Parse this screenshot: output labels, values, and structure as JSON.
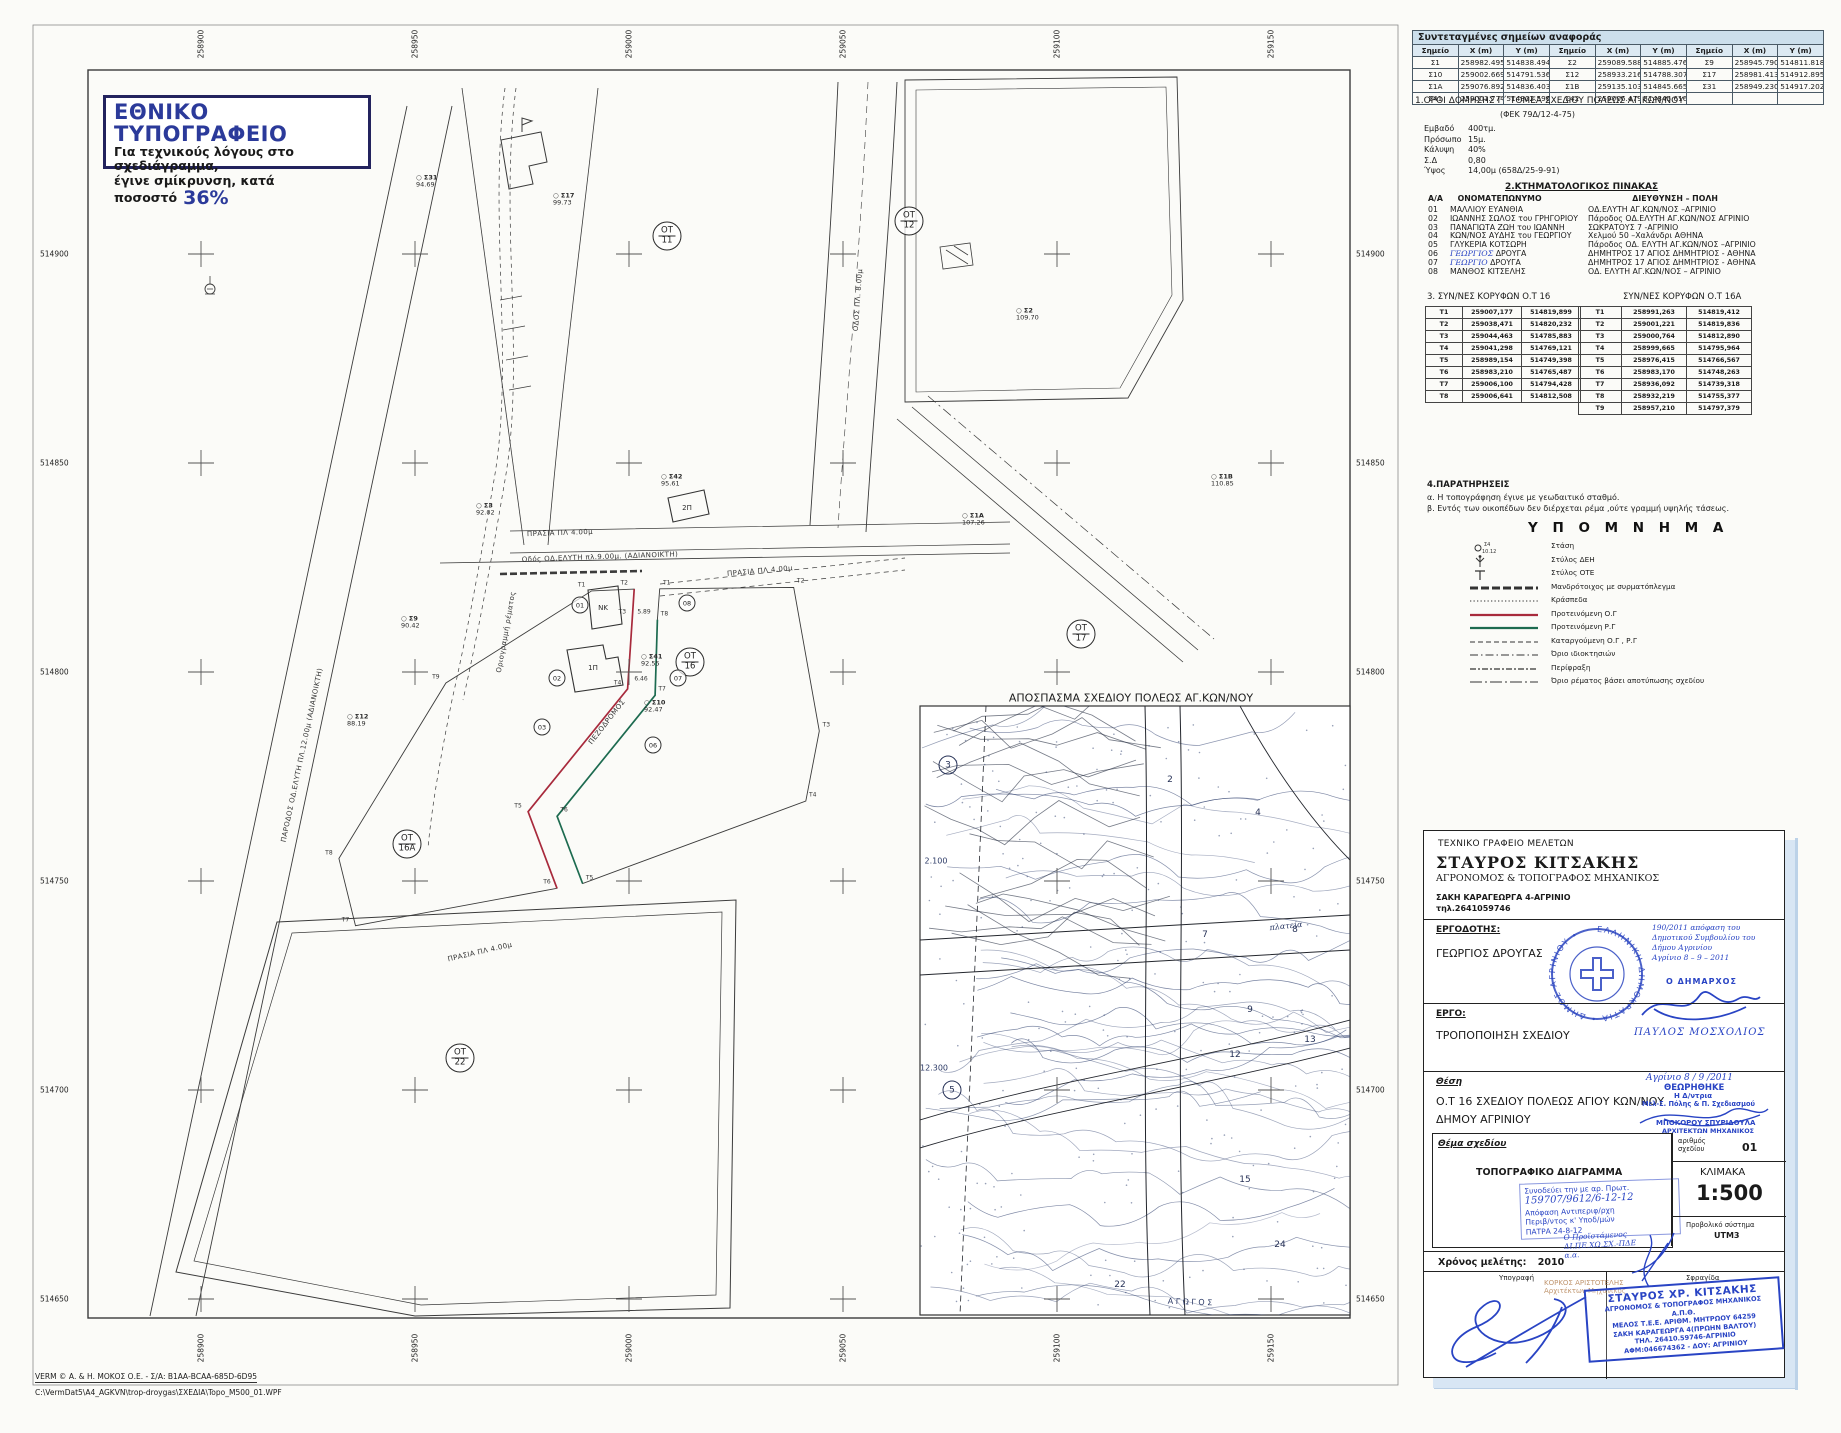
{
  "printer_note": {
    "title": "ΕΘΝΙΚΟ ΤΥΠΟΓΡΑΦΕΙΟ",
    "line1": "Για τεχνικούς λόγους στο σχεδιάγραμμα,",
    "line2": "έγινε σμίκρυνση, κατά ποσοστό",
    "percent": "36%"
  },
  "ref_table": {
    "title": "Συντεταγμένες σημείων αναφοράς",
    "headers": [
      "Σημείο",
      "X (m)",
      "Y (m)",
      "Σημείο",
      "X (m)",
      "Y (m)",
      "Σημείο",
      "X (m)",
      "Y (m)"
    ],
    "rows": [
      [
        "Σ1",
        "258982.495",
        "514838.494",
        "Σ2",
        "259089.588",
        "514885.476",
        "Σ9",
        "258945.790",
        "514811.818"
      ],
      [
        "Σ10",
        "259002.669",
        "514791.536",
        "Σ12",
        "258933.216",
        "514788.307",
        "Σ17",
        "258981.413",
        "514912.895"
      ],
      [
        "Σ1Α",
        "259076.892",
        "514836.403",
        "Σ1Β",
        "259135.103",
        "514845.665",
        "Σ31",
        "258949.230",
        "514917.202"
      ],
      [
        "Σ41",
        "259001.774",
        "514802.596",
        "Σ42",
        "259006.479",
        "514845.616",
        "",
        "",
        ""
      ]
    ]
  },
  "section1": {
    "heading": "1.ΟΡΟΙ ΔΟΜΗΣΗΣ  Γ΄ ΤΟΜΕΑ  ΣΧΕΔΙΟΥ ΠΟΛΕΩΣ ΑΓ.ΚΩΝ/ΝΟΥ",
    "fek": "(ΦΕΚ 79Δ/12-4-75)",
    "items": [
      [
        "Εμβαδό",
        "400τμ."
      ],
      [
        "Πρόσωπο",
        "15μ."
      ],
      [
        "Κάλυψη",
        "40%"
      ],
      [
        "Σ.Δ",
        "0,80"
      ],
      [
        "Ύψος",
        "14,00μ (658Δ/25-9-91)"
      ]
    ]
  },
  "section2": {
    "heading": "2.ΚΤΗΜΑΤΟΛΟΓΙΚΟΣ ΠΙΝΑΚΑΣ",
    "col_no": "Α/Α",
    "col_name": "ΟΝΟΜΑΤΕΠΩΝΥΜΟ",
    "col_addr": "ΔΙΕΥΘΥΝΣΗ – ΠΟΛΗ",
    "rows": [
      {
        "no": "01",
        "name": "ΜΑΛΛΙΟΥ ΕΥΑΝΘΙΑ",
        "addr": "ΟΔ.ΕΛΥΤΗ ΑΓ.ΚΩΝ/ΝΟΣ –ΑΓΡΙΝΙΟ",
        "hw": false
      },
      {
        "no": "02",
        "name": "ΙΩΑΝΝΗΣ ΣΩΛΟΣ του ΓΡΗΓΟΡΙΟΥ",
        "addr": "Πάροδος ΟΔ.ΕΛΥΤΗ ΑΓ.ΚΩΝ/ΝΟΣ ΑΓΡΙΝΙΟ",
        "hw": false
      },
      {
        "no": "03",
        "name": "ΠΑΝΑΓΙΩΤΑ ΖΩΗ του ΙΩΑΝΝΗ",
        "addr": "ΣΩΚΡΑΤΟΥΣ 7 -ΑΓΡΙΝΙΟ",
        "hw": false
      },
      {
        "no": "04",
        "name": "ΚΩΝ/ΝΟΣ ΑΥΔΗΣ του ΓΕΩΡΓΙΟΥ",
        "addr": "Χελμού 50 –Χαλάνδρι ΑΘΗΝΑ",
        "hw": false
      },
      {
        "no": "05",
        "name": "ΓΛΥΚΕΡΙΑ ΚΟΤΣΩΡΗ",
        "addr": "Πάροδος ΟΔ. ΕΛΥΤΗ ΑΓ.ΚΩΝ/ΝΟΣ –ΑΓΡΙΝΙΟ",
        "hw": false
      },
      {
        "no": "06",
        "name": "ΓΕΩΡΓΙΟΣ ΔΡΟΥΓΑ",
        "addr": "ΔΗΜΗΤΡΟΣ 17 ΑΓΙΟΣ ΔΗΜΗΤΡΙΟΣ - ΑΘΗΝΑ",
        "hw": true
      },
      {
        "no": "07",
        "name": "ΓΕΩΡΓΙΟ ΔΡΟΥΓΑ",
        "addr": "ΔΗΜΗΤΡΟΣ 17 ΑΓΙΟΣ ΔΗΜΗΤΡΙΟΣ - ΑΘΗΝΑ",
        "hw": true
      },
      {
        "no": "08",
        "name": "ΜΑΝΘΟΣ ΚΙΤΣΕΛΗΣ",
        "addr": "ΟΔ. ΕΛΥΤΗ ΑΓ.ΚΩΝ/ΝΟΣ – ΑΓΡΙΝΙΟ",
        "hw": false
      }
    ]
  },
  "section3": {
    "heading_left": "3.      ΣΥΝ/ΝΕΣ ΚΟΡΥΦΩΝ Ο.Τ 16",
    "heading_right": "ΣΥΝ/ΝΕΣ ΚΟΡΥΦΩΝ Ο.Τ 16Α",
    "t16": [
      [
        "Τ1",
        "259007,177",
        "514819,899"
      ],
      [
        "Τ2",
        "259038,471",
        "514820,232"
      ],
      [
        "Τ3",
        "259044,463",
        "514785,883"
      ],
      [
        "Τ4",
        "259041,298",
        "514769,121"
      ],
      [
        "Τ5",
        "258989,154",
        "514749,398"
      ],
      [
        "Τ6",
        "258983,210",
        "514765,487"
      ],
      [
        "Τ7",
        "259006,100",
        "514794,428"
      ],
      [
        "Τ8",
        "259006,641",
        "514812,508"
      ]
    ],
    "t16a": [
      [
        "Τ1",
        "258991,263",
        "514819,412"
      ],
      [
        "Τ2",
        "259001,221",
        "514819,836"
      ],
      [
        "Τ3",
        "259000,764",
        "514812,890"
      ],
      [
        "Τ4",
        "258999,665",
        "514795,964"
      ],
      [
        "Τ5",
        "258976,415",
        "514766,567"
      ],
      [
        "Τ6",
        "258983,170",
        "514748,263"
      ],
      [
        "Τ7",
        "258936,092",
        "514739,318"
      ],
      [
        "Τ8",
        "258932,219",
        "514755,377"
      ],
      [
        "Τ9",
        "258957,210",
        "514797,379"
      ]
    ]
  },
  "section4": {
    "heading": "4.ΠΑΡΑΤΗΡΗΣΕΙΣ",
    "note_a": "α. Η τοπογράφηση έγινε με γεωδαιτικό σταθμό.",
    "note_b": "β. Εντός των οικοπέδων δεν διέρχεται ρέμα ,ούτε γραμμή υψηλής τάσεως."
  },
  "legend": {
    "title": "Υ Π Ο Μ Ν Η Μ Α",
    "items": [
      {
        "symbol": "stasi",
        "label": "Στάση"
      },
      {
        "symbol": "deh",
        "label": "Στύλος ΔΕΗ"
      },
      {
        "symbol": "ote",
        "label": "Στύλος ΟΤΕ"
      },
      {
        "symbol": "wall",
        "label": "Μανδρότοιχος με συρματόπλεγμα"
      },
      {
        "symbol": "dots",
        "label": "Κράσπεδα"
      },
      {
        "symbol": "red",
        "label": "Προτεινόμενη Ο.Γ"
      },
      {
        "symbol": "green",
        "label": "Προτεινόμενη Ρ.Γ"
      },
      {
        "symbol": "dashed",
        "label": "Καταργούμενη Ο.Γ , Ρ.Γ"
      },
      {
        "symbol": "dashdot",
        "label": "Όριο ιδιοκτησιών"
      },
      {
        "symbol": "fence",
        "label": "Περίφραξη"
      },
      {
        "symbol": "stream",
        "label": "Όριο ρέματος βάσει αποτύπωσης σχεδίου"
      }
    ],
    "stasi_name": "Σ4",
    "stasi_elev": "10.12"
  },
  "title_block": {
    "office": "ΤΕΧΝΙΚΟ ΓΡΑΦΕΙΟ ΜΕΛΕΤΩΝ",
    "name": "ΣΤΑΥΡΟΣ ΚΙΤΣΑΚΗΣ",
    "profession": "ΑΓΡΟΝΟΜΟΣ & ΤΟΠΟΓΡΑΦΟΣ ΜΗΧΑΝΙΚΟΣ",
    "address": "ΣΑΚΗ ΚΑΡΑΓΕΩΡΓΑ 4-ΑΓΡΙΝΙΟ",
    "phone": "τηλ.2641059746",
    "employer_label": "ΕΡΓΟΔΟΤΗΣ:",
    "employer": "ΓΕΩΡΓΙΟΣ ΔΡΟΥΓΑΣ",
    "project_label": "ΕΡΓΟ:",
    "project": "ΤΡΟΠΟΠΟΙΗΣΗ ΣΧΕΔΙΟΥ",
    "location_label": "Θέση",
    "location_line1": "Ο.Τ 16 ΣΧΕΔΙΟΥ ΠΟΛΕΩΣ ΑΓΙΟΥ ΚΩΝ/ΝΟΥ",
    "location_line2": "ΔΗΜΟΥ ΑΓΡΙΝΙΟΥ",
    "subject_label": "Θέμα σχεδίου",
    "subject": "ΤΟΠΟΓΡΑΦΙΚΟ ΔΙΑΓΡΑΜΜΑ",
    "drawing_no_label1": "αριθμός",
    "drawing_no_label2": "σχεδίου",
    "drawing_no": "01",
    "scale_label": "ΚΛΙΜΑΚΑ",
    "scale": "1:500",
    "projection_label": "Προβολικό σύστημα",
    "projection": "UTM3",
    "study_label": "Χρόνος μελέτης:",
    "study_year": "2010",
    "signature_label": "Υπογραφή",
    "stamp_label": "Σφραγίδα"
  },
  "stamps": {
    "municipal": {
      "ring": "ΕΛΛΗΝΙΚΗ ΔΗΜΟΚΡΑΤΙΑ • ΔΗΜΟΣ ΑΓΡΙΝΙΟΥ •",
      "note_lines": [
        "190/2011 απόφαση του",
        "Δημοτικού Συμβουλίου του",
        "Δήμου Αγρινίου",
        "Αγρίνιο  8 – 9 – 2011"
      ],
      "mayor_label": "Ο  ΔΗΜΑΡΧΟΣ",
      "mayor_name": "ΠΑΥΛΟΣ  ΜΟΣΧΟΛΙΟΣ"
    },
    "approval": {
      "date_line": "Αγρίνιο 8 / 9 /2011",
      "line1": "ΘΕΩΡΗΘΗΚΕ",
      "line2": "Η Δ/ντρια",
      "line3": "Μελ-Σ. Πόλης & Π. Σχεδιασμού",
      "name": "ΜΠΟΚΟΡΟΥ ΣΠΥΡΙΔΟΥΛΑ",
      "title": "ΑΡΧΙΤΕΚΤΩΝ ΜΗΧΑΝΙΚΟΣ"
    },
    "protocol": {
      "lines": [
        "Συνοδεύει την με αρ. Πρωτ.",
        "159707/9612/6-12-12",
        "Απόφαση Αντιπεριφ/ρχη",
        "Περιβ/ντος κ' Υποδ/μών",
        "ΠΑΤΡΑ  24-8-12"
      ]
    },
    "head_official": {
      "lines": [
        "Ο Προϊστάμενος",
        "ΔΙ.ΠΕ.ΧΩ.ΣΧ.-ΠΔΕ",
        "α.α."
      ],
      "name": "ΚΟΡΚΟΣ ΑΡΙΣΤΟΤΕΛΗΣ",
      "title": "Αρχιτέκτων Μηχανικός"
    },
    "engineer": {
      "lines": [
        "ΣΤΑΥΡΟΣ ΧΡ. ΚΙΤΣΑΚΗΣ",
        "ΑΓΡΟΝΟΜΟΣ & ΤΟΠΟΓΡΑΦΟΣ ΜΗΧΑΝΙΚΟΣ Α.Π.Θ.",
        "ΜΕΛΟΣ Τ.Ε.Ε. ΑΡΙΘΜ. ΜΗΤΡΩΟΥ 64259",
        "ΣΑΚΗ ΚΑΡΑΓΕΩΡΓΑ 4(ΠΡΩΗΝ ΒΑΛΤΟΥ)",
        "ΤΗΛ. 26410.59746-ΑΓΡΙΝΙΟ",
        "ΑΦΜ:046674362 - ΔΟΥ: ΑΓΡΙΝΙΟΥ"
      ]
    }
  },
  "map": {
    "inset_title": "ΑΠΟΣΠΑΣΜΑ ΣΧΕΔΙΟΥ ΠΟΛΕΩΣ ΑΓ.ΚΩΝ/ΝΟΥ",
    "grid": {
      "x_positions": [
        201,
        415,
        629,
        843,
        1057,
        1271
      ],
      "y_positions": [
        254,
        463,
        672,
        881,
        1090,
        1299
      ],
      "x_values": [
        "258900",
        "258950",
        "259000",
        "259050",
        "259100",
        "259150"
      ],
      "y_values": [
        "514900",
        "514850",
        "514800",
        "514750",
        "514700",
        "514650"
      ]
    },
    "ot_labels": [
      {
        "block": "ΟΤ",
        "num": "11",
        "x": 667,
        "y": 236
      },
      {
        "block": "ΟΤ",
        "num": "12",
        "x": 909,
        "y": 221
      },
      {
        "block": "ΟΤ",
        "num": "16",
        "x": 690,
        "y": 662
      },
      {
        "block": "ΟΤ",
        "num": "16Α",
        "x": 407,
        "y": 844
      },
      {
        "block": "ΟΤ",
        "num": "17",
        "x": 1081,
        "y": 634
      },
      {
        "block": "ΟΤ",
        "num": "22",
        "x": 460,
        "y": 1058
      }
    ],
    "survey_points": [
      {
        "name": "Σ31",
        "elev": "94.69",
        "x": 412,
        "y": 182
      },
      {
        "name": "Σ17",
        "elev": "99.73",
        "x": 549,
        "y": 200
      },
      {
        "name": "Σ42",
        "elev": "95.61",
        "x": 657,
        "y": 481
      },
      {
        "name": "Σ3",
        "elev": "92.02",
        "x": 472,
        "y": 510
      },
      {
        "name": "Σ1Α",
        "elev": "107.26",
        "x": 958,
        "y": 520
      },
      {
        "name": "Σ1Β",
        "elev": "110.85",
        "x": 1207,
        "y": 481
      },
      {
        "name": "Σ2",
        "elev": "109.70",
        "x": 1012,
        "y": 315
      },
      {
        "name": "Σ9",
        "elev": "90.42",
        "x": 397,
        "y": 623
      },
      {
        "name": "Σ41",
        "elev": "92.55",
        "x": 637,
        "y": 661
      },
      {
        "name": "Σ10",
        "elev": "92.47",
        "x": 640,
        "y": 707
      },
      {
        "name": "Σ12",
        "elev": "88.19",
        "x": 343,
        "y": 721
      }
    ],
    "parcel_numbers": [
      {
        "n": "01",
        "x": 580,
        "y": 605
      },
      {
        "n": "02",
        "x": 557,
        "y": 678
      },
      {
        "n": "03",
        "x": 542,
        "y": 727
      },
      {
        "n": "06",
        "x": 653,
        "y": 745
      },
      {
        "n": "07",
        "x": 678,
        "y": 678
      },
      {
        "n": "08",
        "x": 687,
        "y": 603
      }
    ],
    "building_labels": [
      {
        "t": "ΝΚ",
        "x": 603,
        "y": 608
      },
      {
        "t": "1Π",
        "x": 593,
        "y": 668
      },
      {
        "t": "2Π",
        "x": 687,
        "y": 508
      }
    ],
    "dims": [
      {
        "t": "5.89",
        "x": 644,
        "y": 612
      },
      {
        "t": "6.46",
        "x": 641,
        "y": 679
      }
    ],
    "road_labels": [
      {
        "t": "ΠΡΑΣΙΑ ΠΛ 4.00μ",
        "x": 560,
        "y": 533,
        "r": -2
      },
      {
        "t": "Οδός ΟΔ.ΕΛΥΤΗ πλ.9.00μ. (ΑΔΙΑΝΟΙΚΤΗ)",
        "x": 600,
        "y": 557,
        "r": -2
      },
      {
        "t": "ΠΡΑΣΙΑ ΠΛ 4.00μ",
        "x": 760,
        "y": 571,
        "r": -5
      },
      {
        "t": "ΠΕΖΟΔΡΟΜΟΣ",
        "x": 607,
        "y": 722,
        "r": -52
      },
      {
        "t": "ΠΡΑΣΙΑ ΠΛ 4.00μ",
        "x": 480,
        "y": 952,
        "r": -13
      },
      {
        "t": "ΠΑΡΟΔΟΣ ΟΔ.ΕΛΥΤΗ ΠΛ.12.00μ (ΑΔΙΑΝΟΙΚΤΗ)",
        "x": 302,
        "y": 755,
        "r": -78
      },
      {
        "t": "ΟΔΟΣ ΠΛ. 8.00μ",
        "x": 858,
        "y": 300,
        "r": -86
      },
      {
        "t": "Οριογραμμή ρέματος",
        "x": 506,
        "y": 632,
        "r": -80
      }
    ],
    "inset_numbers_circled": [
      {
        "n": "3",
        "x": 948,
        "y": 765
      },
      {
        "n": "5",
        "x": 952,
        "y": 1090
      }
    ],
    "inset_numbers": [
      {
        "n": "2",
        "x": 1170,
        "y": 780
      },
      {
        "n": "4",
        "x": 1258,
        "y": 813
      },
      {
        "n": "7",
        "x": 1205,
        "y": 935
      },
      {
        "n": "8",
        "x": 1295,
        "y": 930
      },
      {
        "n": "9",
        "x": 1250,
        "y": 1010
      },
      {
        "n": "12",
        "x": 1235,
        "y": 1055
      },
      {
        "n": "13",
        "x": 1310,
        "y": 1040
      },
      {
        "n": "15",
        "x": 1245,
        "y": 1180
      },
      {
        "n": "24",
        "x": 1280,
        "y": 1245
      },
      {
        "n": "22",
        "x": 1120,
        "y": 1285
      }
    ],
    "inset_texts": [
      {
        "t": "πλατεία",
        "x": 1286,
        "y": 926,
        "r": -6,
        "hw": true
      },
      {
        "t": "Α Γ Ω Γ Ο Σ",
        "x": 1190,
        "y": 1302,
        "r": 2,
        "hw": false
      },
      {
        "t": "12.300",
        "x": 934,
        "y": 1068,
        "r": 0,
        "hw": false
      },
      {
        "t": "2.100",
        "x": 936,
        "y": 861,
        "r": 0,
        "hw": false
      }
    ]
  },
  "footer": {
    "verm_line": "VERM © Α. & Η. ΜΟΚΟΣ Ο.Ε. - Σ/Α: Β1ΑΑ-ΒCΑΑ-685D-6D95",
    "path_line": "C:\\VermDat5\\A4_AGKVN\\trop-droygas\\ΣΧΕΔΙΑ\\Topo_M500_01.WPF"
  }
}
